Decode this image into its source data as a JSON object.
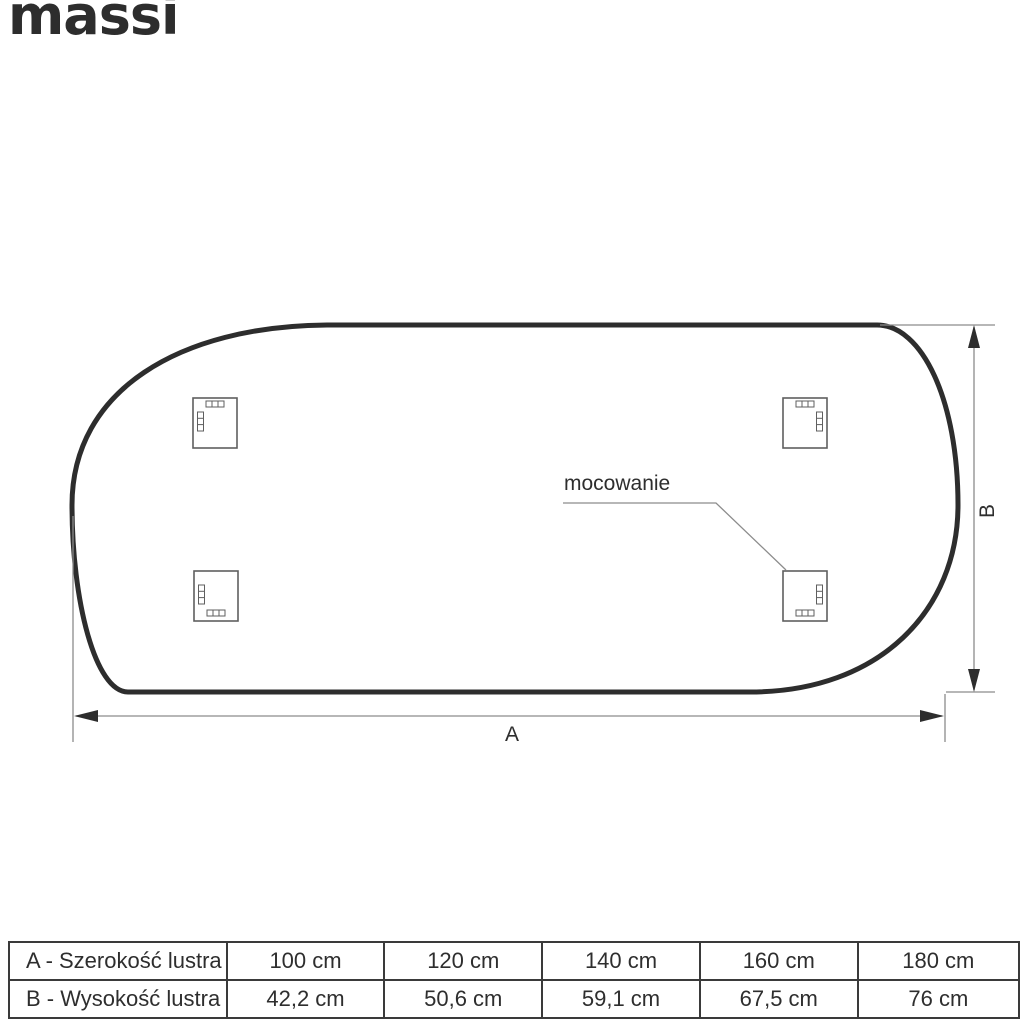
{
  "brand": {
    "logo_text": "massi"
  },
  "diagram": {
    "mounting_label": "mocowanie",
    "width_dim_label": "A",
    "height_dim_label": "B",
    "colors": {
      "outline": "#2d2d2d",
      "dimension_line": "#8c8c8c",
      "bracket_outline": "#5f5f5f",
      "background": "#ffffff"
    }
  },
  "size_table": {
    "rows": [
      {
        "header": "A - Szerokość lustra",
        "values": [
          "100 cm",
          "120 cm",
          "140 cm",
          "160 cm",
          "180 cm"
        ]
      },
      {
        "header": "B - Wysokość lustra",
        "values": [
          "42,2 cm",
          "50,6 cm",
          "59,1 cm",
          "67,5 cm",
          "76 cm"
        ]
      }
    ]
  }
}
